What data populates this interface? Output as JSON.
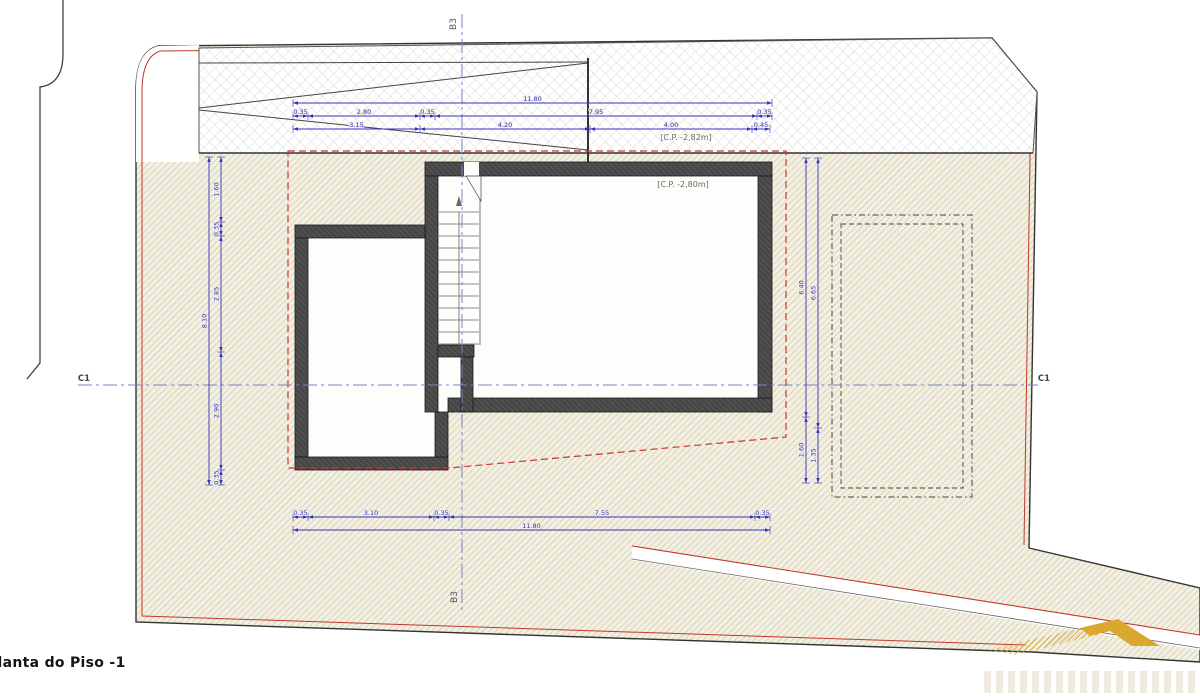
{
  "title": {
    "label": "Planta do Piso -1"
  },
  "markers": {
    "section_vertical_top": "B3",
    "section_vertical_bottom": "B3",
    "section_horizontal_left": "C1",
    "section_horizontal_right": "C1"
  },
  "annotations": {
    "pavement_level": "[C.P. -2,82m]",
    "floor_level": "[C.P. -2,80m]"
  },
  "colors": {
    "dimension_blue": "#3434bb",
    "centerline_blue": "#7585c8",
    "boundary_red": "#c0392b",
    "wall_gray": "#474747",
    "site_hatch_line": "#cdc099",
    "site_hatch_bg": "#f2efe3",
    "paving_grid": "#d9d9d9",
    "logo_gold": "#d9a62b",
    "line_black": "#333333"
  },
  "dimensions": {
    "groups": [
      {
        "name": "top-horizontal",
        "type": "h",
        "rows": [
          {
            "pos": 103,
            "segments": [
              {
                "from": 293,
                "to": 772,
                "label": "11.80"
              }
            ]
          },
          {
            "pos": 116,
            "segments": [
              {
                "from": 293,
                "to": 308,
                "label": "0.35"
              },
              {
                "from": 308,
                "to": 420,
                "label": "2.80"
              },
              {
                "from": 420,
                "to": 435,
                "label": "0.35"
              },
              {
                "from": 435,
                "to": 757,
                "label": "7.95"
              },
              {
                "from": 757,
                "to": 772,
                "label": "0.35"
              }
            ]
          },
          {
            "pos": 129,
            "segments": [
              {
                "from": 293,
                "to": 420,
                "label": "3.15"
              },
              {
                "from": 420,
                "to": 590,
                "label": "4.20"
              },
              {
                "from": 590,
                "to": 752,
                "label": "4.00"
              },
              {
                "from": 752,
                "to": 770,
                "label": "0.45"
              }
            ]
          }
        ]
      },
      {
        "name": "bottom-horizontal",
        "type": "h",
        "rows": [
          {
            "pos": 517,
            "segments": [
              {
                "from": 293,
                "to": 308,
                "label": "0.35"
              },
              {
                "from": 308,
                "to": 434,
                "label": "3.10"
              },
              {
                "from": 434,
                "to": 449,
                "label": "0.35"
              },
              {
                "from": 449,
                "to": 755,
                "label": "7.55"
              },
              {
                "from": 755,
                "to": 770,
                "label": "0.35"
              }
            ]
          },
          {
            "pos": 530,
            "segments": [
              {
                "from": 293,
                "to": 770,
                "label": "11.80"
              }
            ]
          }
        ]
      },
      {
        "name": "left-vertical",
        "type": "v",
        "rows": [
          {
            "pos": 209,
            "segments": [
              {
                "from": 157,
                "to": 485,
                "label": "8.10"
              }
            ]
          },
          {
            "pos": 221,
            "segments": [
              {
                "from": 157,
                "to": 222,
                "label": "1.60"
              },
              {
                "from": 222,
                "to": 236,
                "label": "0.35"
              },
              {
                "from": 236,
                "to": 352,
                "label": "2.85"
              },
              {
                "from": 352,
                "to": 470,
                "label": "2.90"
              },
              {
                "from": 470,
                "to": 485,
                "label": "0.35"
              }
            ]
          }
        ]
      },
      {
        "name": "right-vertical",
        "type": "v",
        "rows": [
          {
            "pos": 806,
            "segments": [
              {
                "from": 158,
                "to": 417,
                "label": "6.40"
              },
              {
                "from": 417,
                "to": 483,
                "label": "1.60"
              }
            ]
          },
          {
            "pos": 818,
            "segments": [
              {
                "from": 158,
                "to": 428,
                "label": "6.65"
              },
              {
                "from": 428,
                "to": 483,
                "label": "1.35"
              }
            ]
          }
        ]
      }
    ]
  }
}
